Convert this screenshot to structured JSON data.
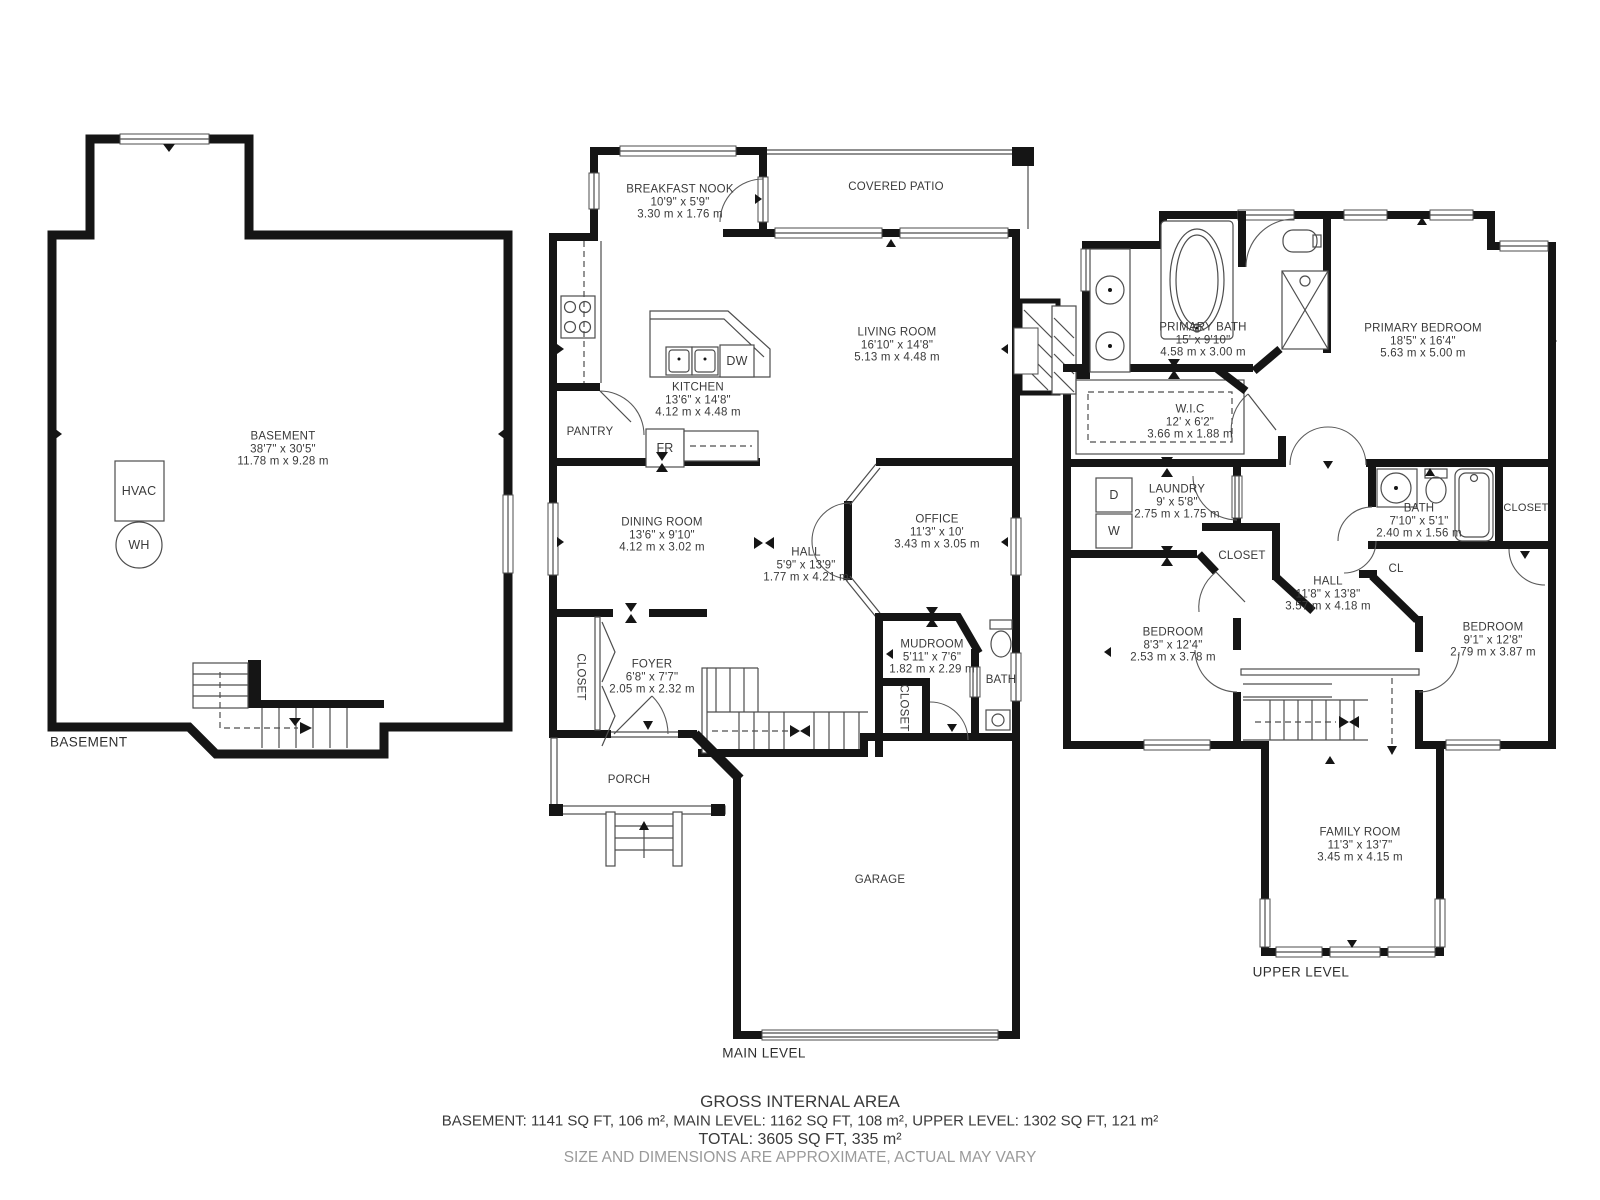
{
  "footer": {
    "gross": "GROSS INTERNAL AREA",
    "areas": "BASEMENT: 1141 SQ FT, 106 m², MAIN LEVEL: 1162 SQ FT, 108 m², UPPER LEVEL: 1302 SQ FT, 121 m²",
    "total": "TOTAL: 3605 SQ FT, 335 m²",
    "disclaimer": "SIZE AND DIMENSIONS ARE APPROXIMATE, ACTUAL MAY VARY"
  },
  "floor_labels": {
    "basement": "BASEMENT",
    "main": "MAIN LEVEL",
    "upper": "UPPER LEVEL"
  },
  "rooms": {
    "basement": {
      "name": "BASEMENT",
      "imperial": "38'7\" x 30'5\"",
      "metric": "11.78 m x 9.28 m"
    },
    "breakfast_nook": {
      "name": "BREAKFAST NOOK",
      "imperial": "10'9\" x 5'9\"",
      "metric": "3.30 m x 1.76 m"
    },
    "living_room": {
      "name": "LIVING ROOM",
      "imperial": "16'10\" x 14'8\"",
      "metric": "5.13 m x 4.48 m"
    },
    "kitchen": {
      "name": "KITCHEN",
      "imperial": "13'6\" x 14'8\"",
      "metric": "4.12 m x 4.48 m"
    },
    "dining_room": {
      "name": "DINING ROOM",
      "imperial": "13'6\" x 9'10\"",
      "metric": "4.12 m x 3.02 m"
    },
    "hall_main": {
      "name": "HALL",
      "imperial": "5'9\" x 13'9\"",
      "metric": "1.77 m x 4.21 m"
    },
    "office": {
      "name": "OFFICE",
      "imperial": "11'3\" x 10'",
      "metric": "3.43 m x 3.05 m"
    },
    "foyer": {
      "name": "FOYER",
      "imperial": "6'8\" x 7'7\"",
      "metric": "2.05 m x 2.32 m"
    },
    "mudroom": {
      "name": "MUDROOM",
      "imperial": "5'11\" x 7'6\"",
      "metric": "1.82 m x 2.29 m"
    },
    "primary_bath": {
      "name": "PRIMARY BATH",
      "imperial": "15' x 9'10\"",
      "metric": "4.58 m x 3.00 m"
    },
    "primary_bedroom": {
      "name": "PRIMARY BEDROOM",
      "imperial": "18'5\" x 16'4\"",
      "metric": "5.63 m x 5.00 m"
    },
    "wic": {
      "name": "W.I.C",
      "imperial": "12' x 6'2\"",
      "metric": "3.66 m x 1.88 m"
    },
    "laundry": {
      "name": "LAUNDRY",
      "imperial": "9' x 5'8\"",
      "metric": "2.75 m x 1.75 m"
    },
    "bath_upper": {
      "name": "BATH",
      "imperial": "7'10\" x 5'1\"",
      "metric": "2.40 m x 1.56 m"
    },
    "hall_upper": {
      "name": "HALL",
      "imperial": "11'8\" x 13'8\"",
      "metric": "3.57 m x 4.18 m"
    },
    "bedroom_left": {
      "name": "BEDROOM",
      "imperial": "8'3\" x 12'4\"",
      "metric": "2.53 m x 3.78 m"
    },
    "bedroom_right": {
      "name": "BEDROOM",
      "imperial": "9'1\" x 12'8\"",
      "metric": "2.79 m x 3.87 m"
    },
    "family_room": {
      "name": "FAMILY ROOM",
      "imperial": "11'3\" x 13'7\"",
      "metric": "3.45 m x 4.15 m"
    }
  },
  "labels": {
    "covered_patio": "COVERED PATIO",
    "pantry": "PANTRY",
    "closet": "CLOSET",
    "cl": "CL",
    "bath": "BATH",
    "porch": "PORCH",
    "garage": "GARAGE"
  },
  "fixtures": {
    "hvac": "HVAC",
    "wh": "WH",
    "fridge": "FR",
    "dishwasher": "DW",
    "dryer": "D",
    "washer": "W"
  },
  "colors": {
    "wall": "#151515",
    "thin_line": "#4d4d4d",
    "text": "#3a3a3a",
    "muted_text": "#9a9a9a"
  }
}
